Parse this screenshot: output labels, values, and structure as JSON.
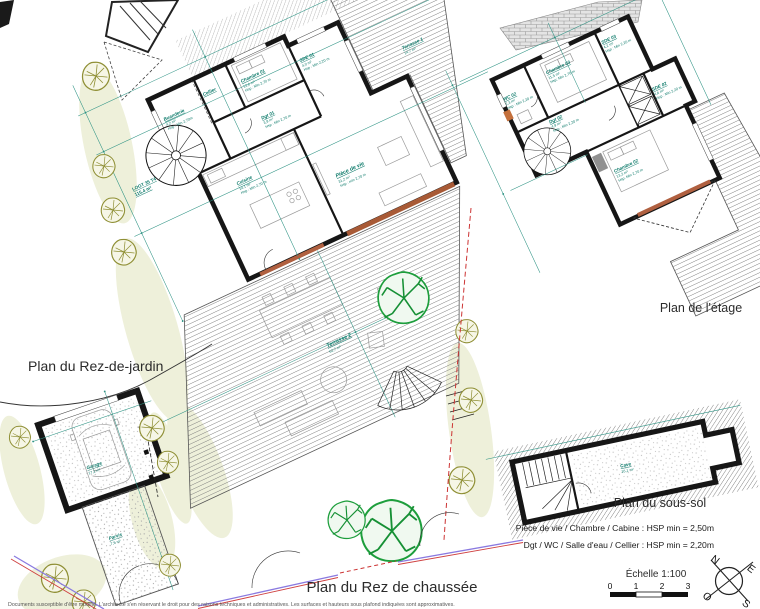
{
  "colors": {
    "wall": "#161616",
    "label_teal": "#0c7a6a",
    "dim_line": "#2e9384",
    "tree_olive": "#8f8f35",
    "tree_green": "#1d9e3c",
    "garden_beige": "#eef0da",
    "boundary_red": "#cc3333",
    "boundary_purple": "#8a7ae0",
    "door_orange": "#c4703c"
  },
  "plans": {
    "rdc": {
      "title": "Plan du Rez de chaussée",
      "lot": {
        "line1": "LOGT 35 T4",
        "line2": "115,4 m²"
      },
      "rooms": [
        {
          "name": "Buanderie",
          "area": "4,2 m²",
          "hsp": "Hsp : Min 2,70m"
        },
        {
          "name": "Cellier",
          "area": "",
          "hsp": ""
        },
        {
          "name": "Chambre 01",
          "area": "12,6 m²",
          "hsp": "Hsp : Min 2,70 m"
        },
        {
          "name": "Dgt 01",
          "area": "3,9 m²",
          "hsp": "Hsp : Min 2,70 m"
        },
        {
          "name": "SDE 01",
          "area": "4,0 m²",
          "hsp": "Hsp : Min 2,20 m"
        },
        {
          "name": "Cuisine",
          "area": "14,1 m²",
          "hsp": "Hsp : Min 2,70 m"
        },
        {
          "name": "Pièce de vie",
          "area": "31,2 m²",
          "hsp": "Hsp : min 2,70 m"
        },
        {
          "name": "Terrasse 1",
          "area": "14,7 m²",
          "hsp": ""
        },
        {
          "name": "Terrasse 2",
          "area": "62,7 m²",
          "hsp": ""
        }
      ]
    },
    "etage": {
      "title": "Plan de l'étage",
      "rooms": [
        {
          "name": "Chambre 03",
          "area": "11,5 m²",
          "hsp": "Hsp: Min 2,70 m"
        },
        {
          "name": "WC 02",
          "area": "2,3 m²",
          "hsp": "Hsp : Min 2,20 m"
        },
        {
          "name": "SDE 03",
          "area": "4,2 m²",
          "hsp": "Hsp : Min 2,20 m"
        },
        {
          "name": "SDE 02",
          "area": "4,6 m²",
          "hsp": "Hsp : Min 2,20 m"
        },
        {
          "name": "Dgt 02",
          "area": "4,9 m²",
          "hsp": "Hsp : Min 2,20 m"
        },
        {
          "name": "Chambre 02",
          "area": "13,2 m²",
          "hsp": "Hsp: Min 2,70 m"
        }
      ]
    },
    "jardin": {
      "title": "Plan du Rez-de-jardin",
      "rooms": [
        {
          "name": "Garage",
          "area": "17,2 m²"
        },
        {
          "name": "Parvis",
          "area": "7,5 m²"
        }
      ]
    },
    "soussol": {
      "title": "Plan du sous-sol",
      "rooms": [
        {
          "name": "Cave",
          "area": "16,1 m²"
        }
      ]
    }
  },
  "notes": {
    "line1": "Pièce de vie / Chambre / Cabine : HSP min = 2,50m",
    "line2": "Dgt / WC / Salle d'eau / Cellier : HSP min = 2,20m"
  },
  "scale": {
    "label": "Échelle 1:100",
    "ticks": [
      "0",
      "1",
      "2",
      "3"
    ]
  },
  "compass": {
    "n": "N",
    "e": "E",
    "s": "S",
    "o": "O"
  },
  "footer": "Documents susceptible d'être modifié. L'architecte s'en réservant le droit pour des raisons techniques et administratives. Les surfaces et hauteurs sous plafond indiquées sont approximatives."
}
